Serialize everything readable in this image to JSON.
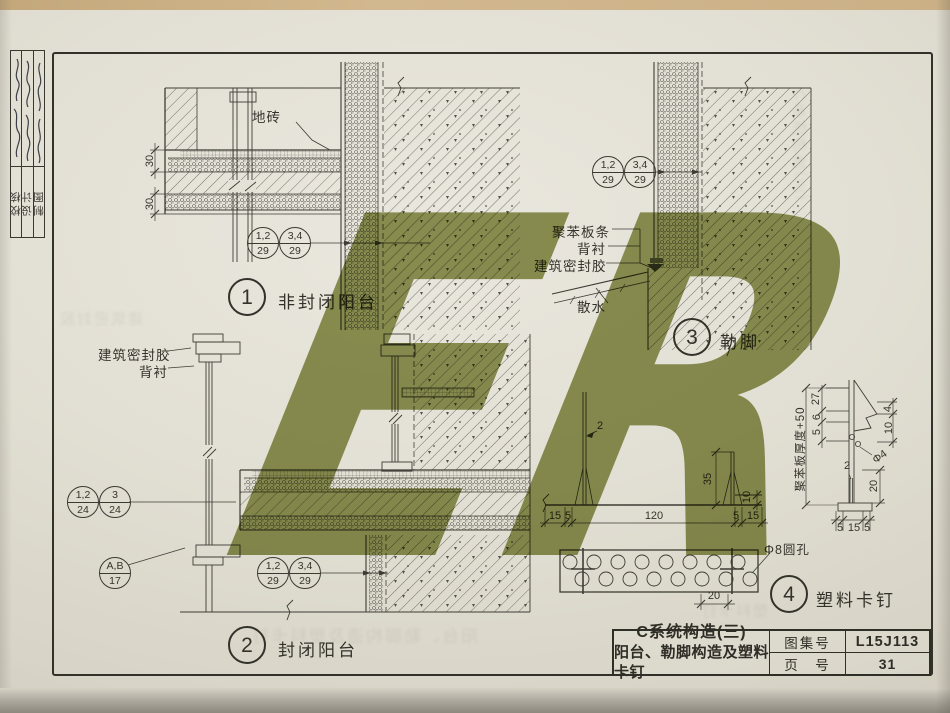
{
  "page": {
    "signature_strip": {
      "rows": [
        {
          "label": "校核"
        },
        {
          "label": "设计"
        },
        {
          "label": "制图"
        }
      ]
    },
    "title_block": {
      "title_line1": "C系统构造(三)",
      "title_line2": "阳台、勒脚构造及塑料卡钉",
      "atlas_label": "图集号",
      "atlas_no": "L15J113",
      "page_label": "页　号",
      "page_no": "31"
    }
  },
  "details": {
    "d1": {
      "number": "1",
      "title": "非封闭阳台",
      "tile_label": "地砖",
      "dim_a": "30",
      "dim_b": "30",
      "bubble1": {
        "top": "1,2",
        "bottom": "29"
      },
      "bubble2": {
        "top": "3,4",
        "bottom": "29"
      }
    },
    "d2": {
      "number": "2",
      "title": "封闭阳台",
      "sealant_label": "建筑密封胶",
      "backing_label": "背衬",
      "bubble1": {
        "top": "1,2",
        "bottom": "24"
      },
      "bubble2": {
        "top": "3",
        "bottom": "24"
      },
      "bubble3": {
        "top": "A,B",
        "bottom": "17"
      },
      "bubble4": {
        "top": "1,2",
        "bottom": "29"
      },
      "bubble5": {
        "top": "3,4",
        "bottom": "29"
      }
    },
    "d3": {
      "number": "3",
      "title": "勒脚",
      "strip_label": "聚苯板条",
      "backing_label": "背衬",
      "sealant_label": "建筑密封胶",
      "apron_label": "散水",
      "bubble1": {
        "top": "1,2",
        "bottom": "29"
      },
      "bubble2": {
        "top": "3,4",
        "bottom": "29"
      }
    },
    "d4": {
      "number": "4",
      "title": "塑料卡钉",
      "hole_label": "Φ8圆孔",
      "dims": {
        "w1": "15",
        "w2": "5",
        "w3": "120",
        "w4": "5",
        "w5": "15",
        "h35": "35",
        "h10": "10",
        "t2": "2",
        "s20": "20"
      },
      "profile": {
        "board_label": "聚苯板厚度+50",
        "d27": "27",
        "d6": "6",
        "d5": "5",
        "r4": "4",
        "r10": "10",
        "hole": "Φ4",
        "t2": "2",
        "r20": "20",
        "b5a": "5",
        "b15": "15",
        "b5b": "5"
      }
    }
  }
}
